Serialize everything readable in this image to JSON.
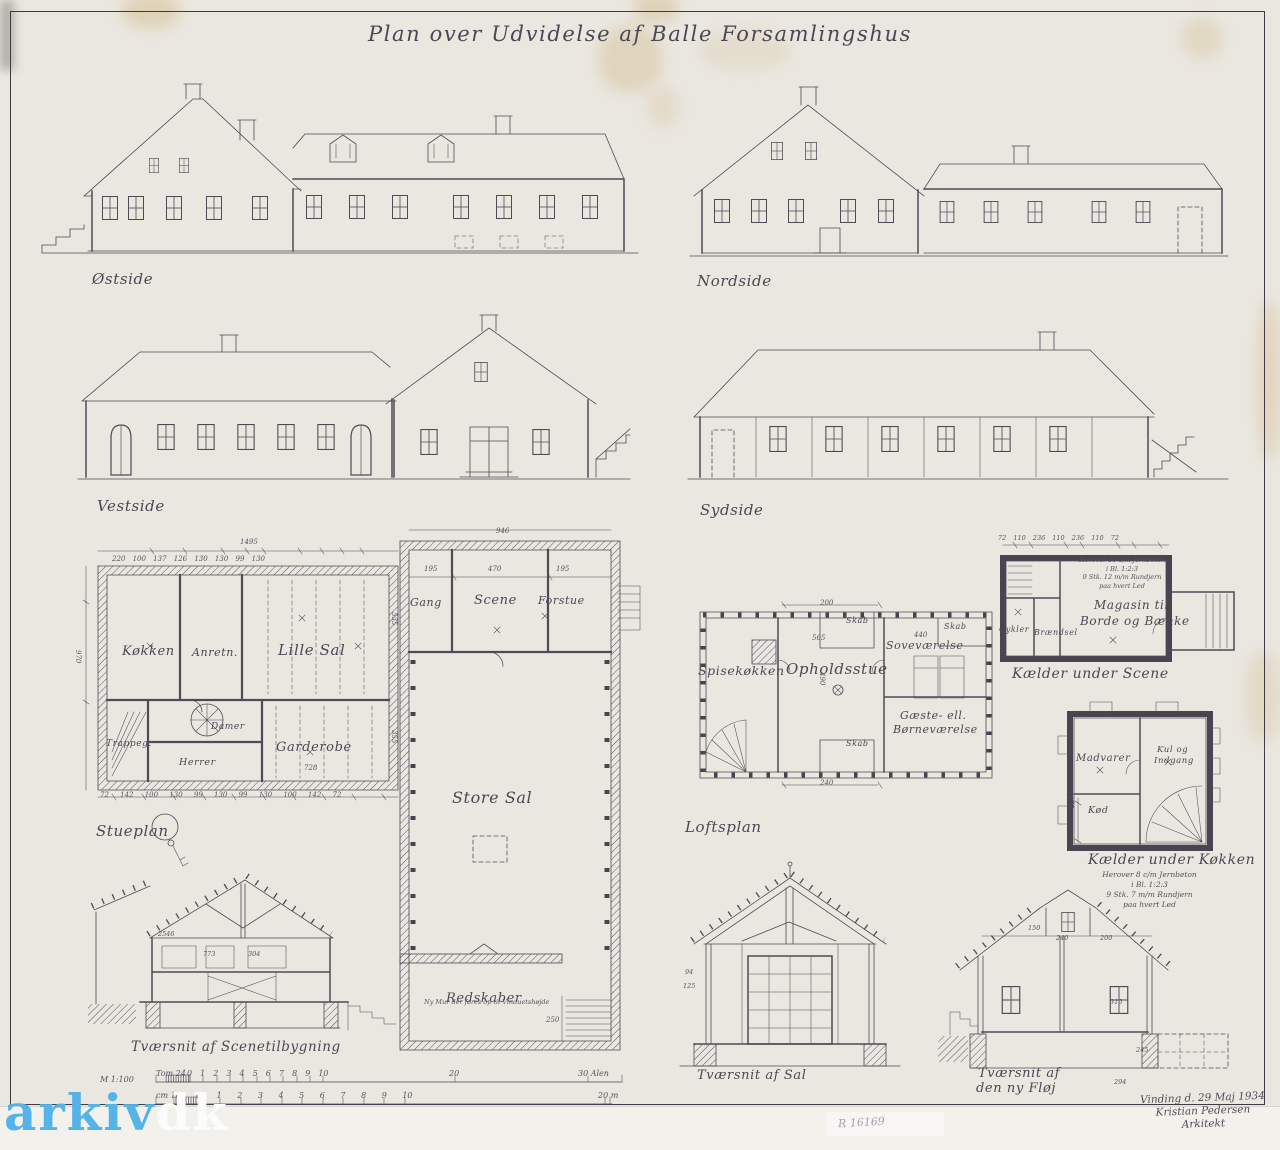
{
  "sheet": {
    "title": "Plan over Udvidelse af Balle Forsamlingshus",
    "stamp": "R 16169",
    "watermark": {
      "blue": "arkiv",
      "white": "dk"
    },
    "signature": [
      "Vinding d. 29 Maj 1934",
      "Kristian Pedersen",
      "Arkitekt"
    ]
  },
  "labels": {
    "ostside": "Østside",
    "nordside": "Nordside",
    "vestside": "Vestside",
    "sydside": "Sydside",
    "stueplan": "Stueplan",
    "loftsplan": "Loftsplan",
    "kaelder_scene": "Kælder under Scene",
    "kaelder_kokken": "Kælder under Køkken",
    "snit_scene": "Tværsnit af Scenetilbygning",
    "snit_sal": "Tværsnit af Sal",
    "snit_floj_1": "Tværsnit af",
    "snit_floj_2": "den ny Fløj"
  },
  "rooms": {
    "kokken": "Køkken",
    "anretn": "Anretn.",
    "lille_sal": "Lille Sal",
    "trappegang": "Trappeg.",
    "damer": "Damer",
    "herrer": "Herrer",
    "garderobe": "Garderobe",
    "gang": "Gang",
    "scene": "Scene",
    "forstue": "Forstue",
    "store_sal": "Store Sal",
    "redskaber": "Redskaber",
    "spisekokken": "Spisekøkken",
    "opholdsstue": "Opholdsstue",
    "sovevaerelse": "Soveværelse",
    "gaeste_1": "Gæste- ell.",
    "gaeste_2": "Børneværelse",
    "skab": "Skab",
    "magasin_1": "Magasin til",
    "magasin_2": "Borde og Bænke",
    "cykler": "Cykler",
    "braendsel": "Brændsel",
    "madvarer": "Madvarer",
    "kul_1": "Kul og",
    "kul_2": "Indgang",
    "kod": "Kød"
  },
  "notes": {
    "scene_kaelder": [
      "Herover 10 c/m Jernbeton",
      "i Bl. 1:2:3",
      "9 Stk. 12 m/m Rundjern",
      "paa hvert Led"
    ],
    "kokken_kaelder": [
      "Herover 8 c/m Jernbeton",
      "i Bl. 1:2:3",
      "9 Stk. 7 m/m Rundjern",
      "paa hvert Led"
    ],
    "store_sal_wall": "Ny Mur der føres op til Vinduetshøjde"
  },
  "dims": {
    "stueplan_total": "1495",
    "stueplan_top": "220 100 137 126 130 130 99 130",
    "stueplan_bottom": "72 142 100 130 99 130 99 130 100 142 72",
    "stueplan_left": "970",
    "lillesal": "535",
    "garderobe_w": "728",
    "garderobe_h": "355",
    "scene_total": "946",
    "scene_a": "195",
    "scene_b": "470",
    "scene_c": "195",
    "redskaber": "250",
    "loft_top": "200",
    "loft_mid": "565",
    "loft_sove": "440",
    "loft_h": "490",
    "loft_bottom": "240",
    "ks_row": "72 110 236 110 236 110 72",
    "kk_h": "175",
    "sal_a": "94",
    "sal_b": "125",
    "st_a": "2546",
    "st_b": "773",
    "st_c": "304",
    "nf_a": "150",
    "nf_b": "240",
    "nf_c": "200",
    "nf_d": "310",
    "nf_e": "245",
    "nf_f": "294"
  },
  "scalebar": {
    "scale_note": "M 1:100",
    "label_top": "Tom 24",
    "ticks_top": "0 1 2 3 4 5 6 7 8 9 10",
    "t20": "20",
    "t30": "30 Alen",
    "label_bot": "cm 100",
    "ticks_bot": "0 1 2 3 4 5 6 7 8 9 10",
    "b20": "20 m"
  }
}
